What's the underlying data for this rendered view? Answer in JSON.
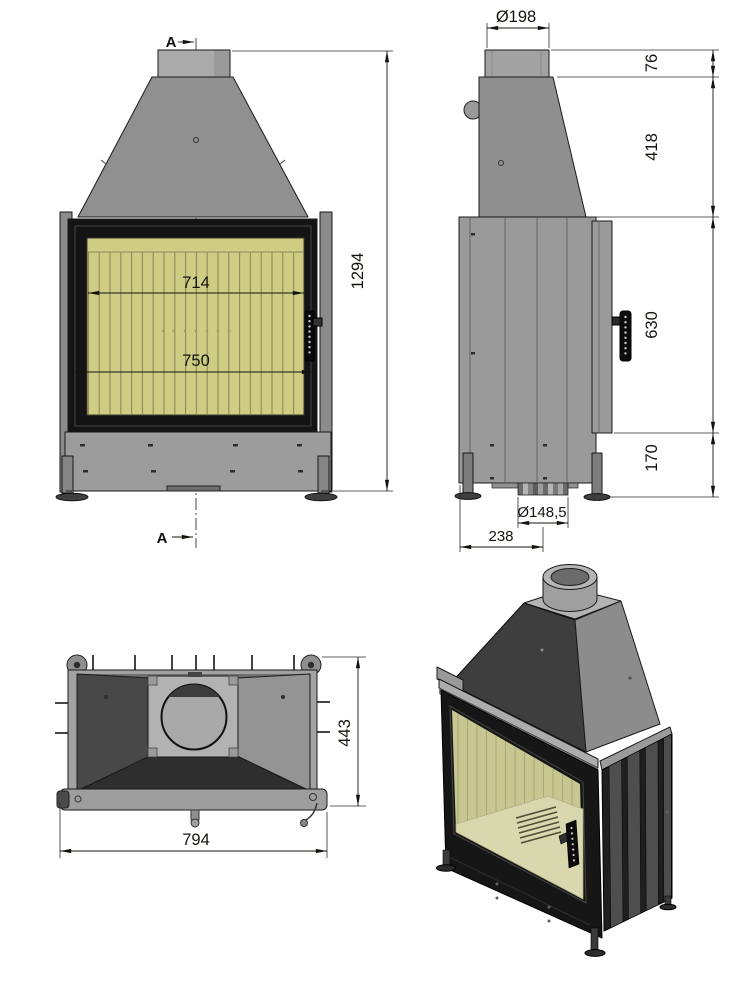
{
  "drawing": {
    "section_marker": "A",
    "front_view": {
      "overall_height": "1294",
      "firebox_width": "714",
      "glass_width": "750"
    },
    "side_view": {
      "flue_diameter": "Ø198",
      "collar_height": "76",
      "hood_height": "418",
      "firebox_height": "630",
      "base_height": "170",
      "air_inlet_diameter": "Ø148,5",
      "air_inlet_offset": "238"
    },
    "top_view": {
      "depth": "443",
      "width": "794"
    },
    "colors": {
      "line": "#1a1a1a",
      "body_gray": "#9b9b9b",
      "hood_gray": "#8f8f8f",
      "dark_face": "#3f3f3f",
      "frame_black": "#161616",
      "firebrick": "#cfcc84",
      "plate_gray": "#b2b2b2",
      "background": "#ffffff"
    }
  }
}
